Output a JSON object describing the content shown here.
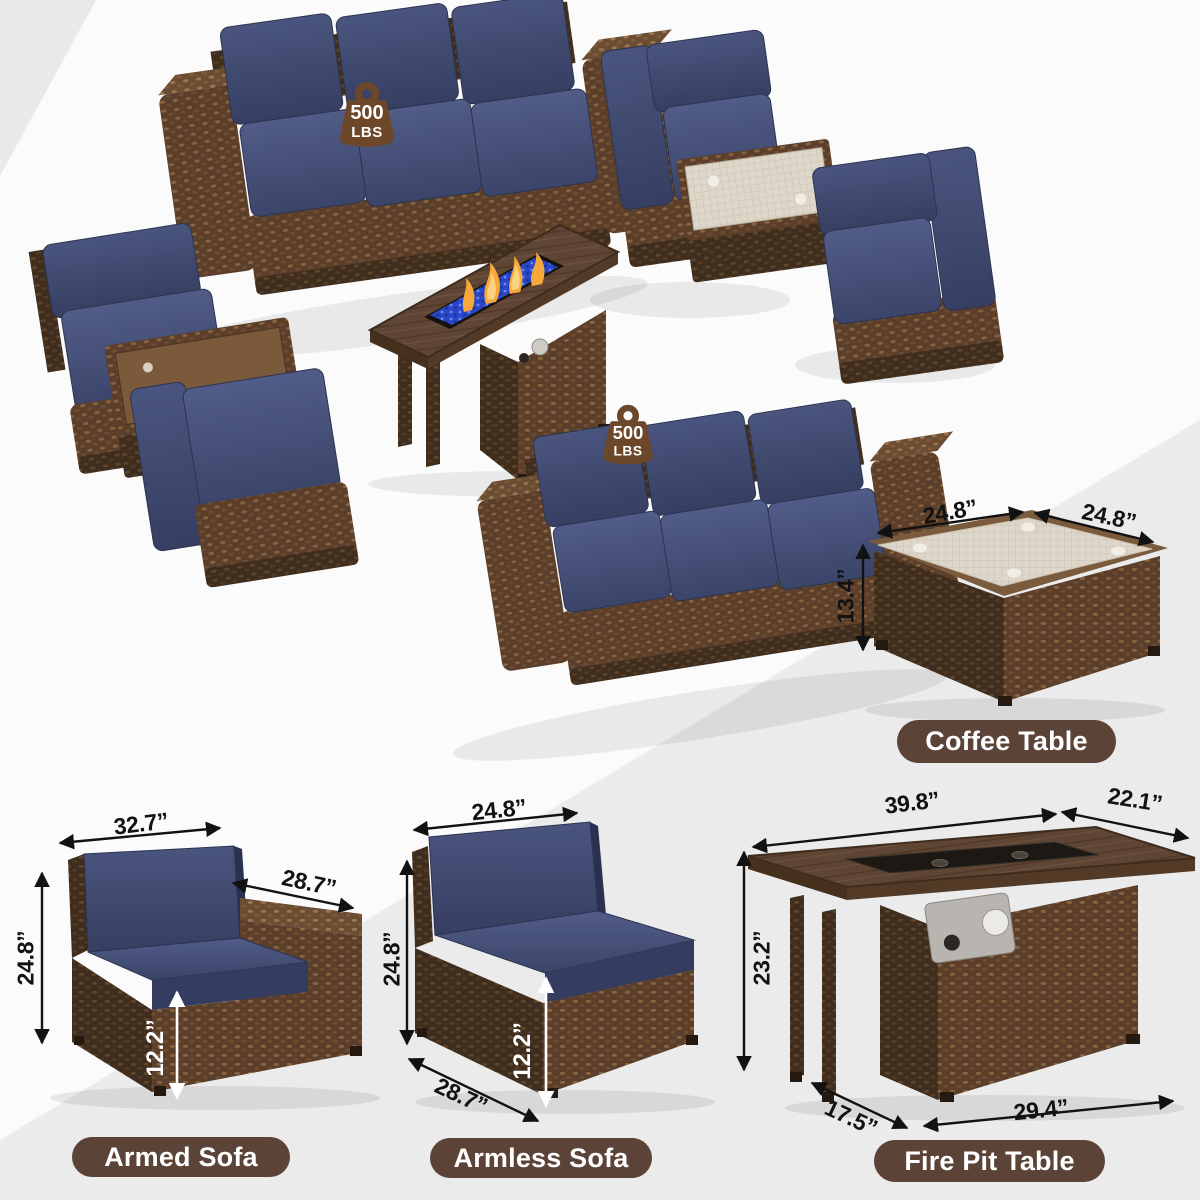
{
  "scene": {
    "badge_1": {
      "value": "500",
      "unit": "LBS"
    },
    "badge_2": {
      "value": "500",
      "unit": "LBS"
    }
  },
  "coffee_table": {
    "label": "Coffee Table",
    "dim_width": "24.8”",
    "dim_depth": "24.8”",
    "dim_height": "13.4”"
  },
  "armed_sofa": {
    "label": "Armed Sofa",
    "dim_width": "32.7”",
    "dim_depth": "28.7”",
    "dim_height": "24.8”",
    "dim_seat_height": "12.2”"
  },
  "armless_sofa": {
    "label": "Armless Sofa",
    "dim_width": "24.8”",
    "dim_height": "24.8”",
    "dim_seat_height": "12.2”",
    "dim_depth": "28.7”"
  },
  "fire_pit_table": {
    "label": "Fire Pit Table",
    "dim_top_width": "39.8”",
    "dim_top_depth": "22.1”",
    "dim_height": "23.2”",
    "dim_base_depth": "17.5”",
    "dim_base_width": "29.4”"
  },
  "colors": {
    "wicker_brown": "#5b3f2a",
    "cushion_navy": "#3e4867",
    "label_pill_brown": "#5c4337",
    "badge_brown": "#6d4729",
    "fire_glass_blue": "#2a47c9",
    "flame_orange": "#f7a83b",
    "dimension_text": "#121212"
  }
}
